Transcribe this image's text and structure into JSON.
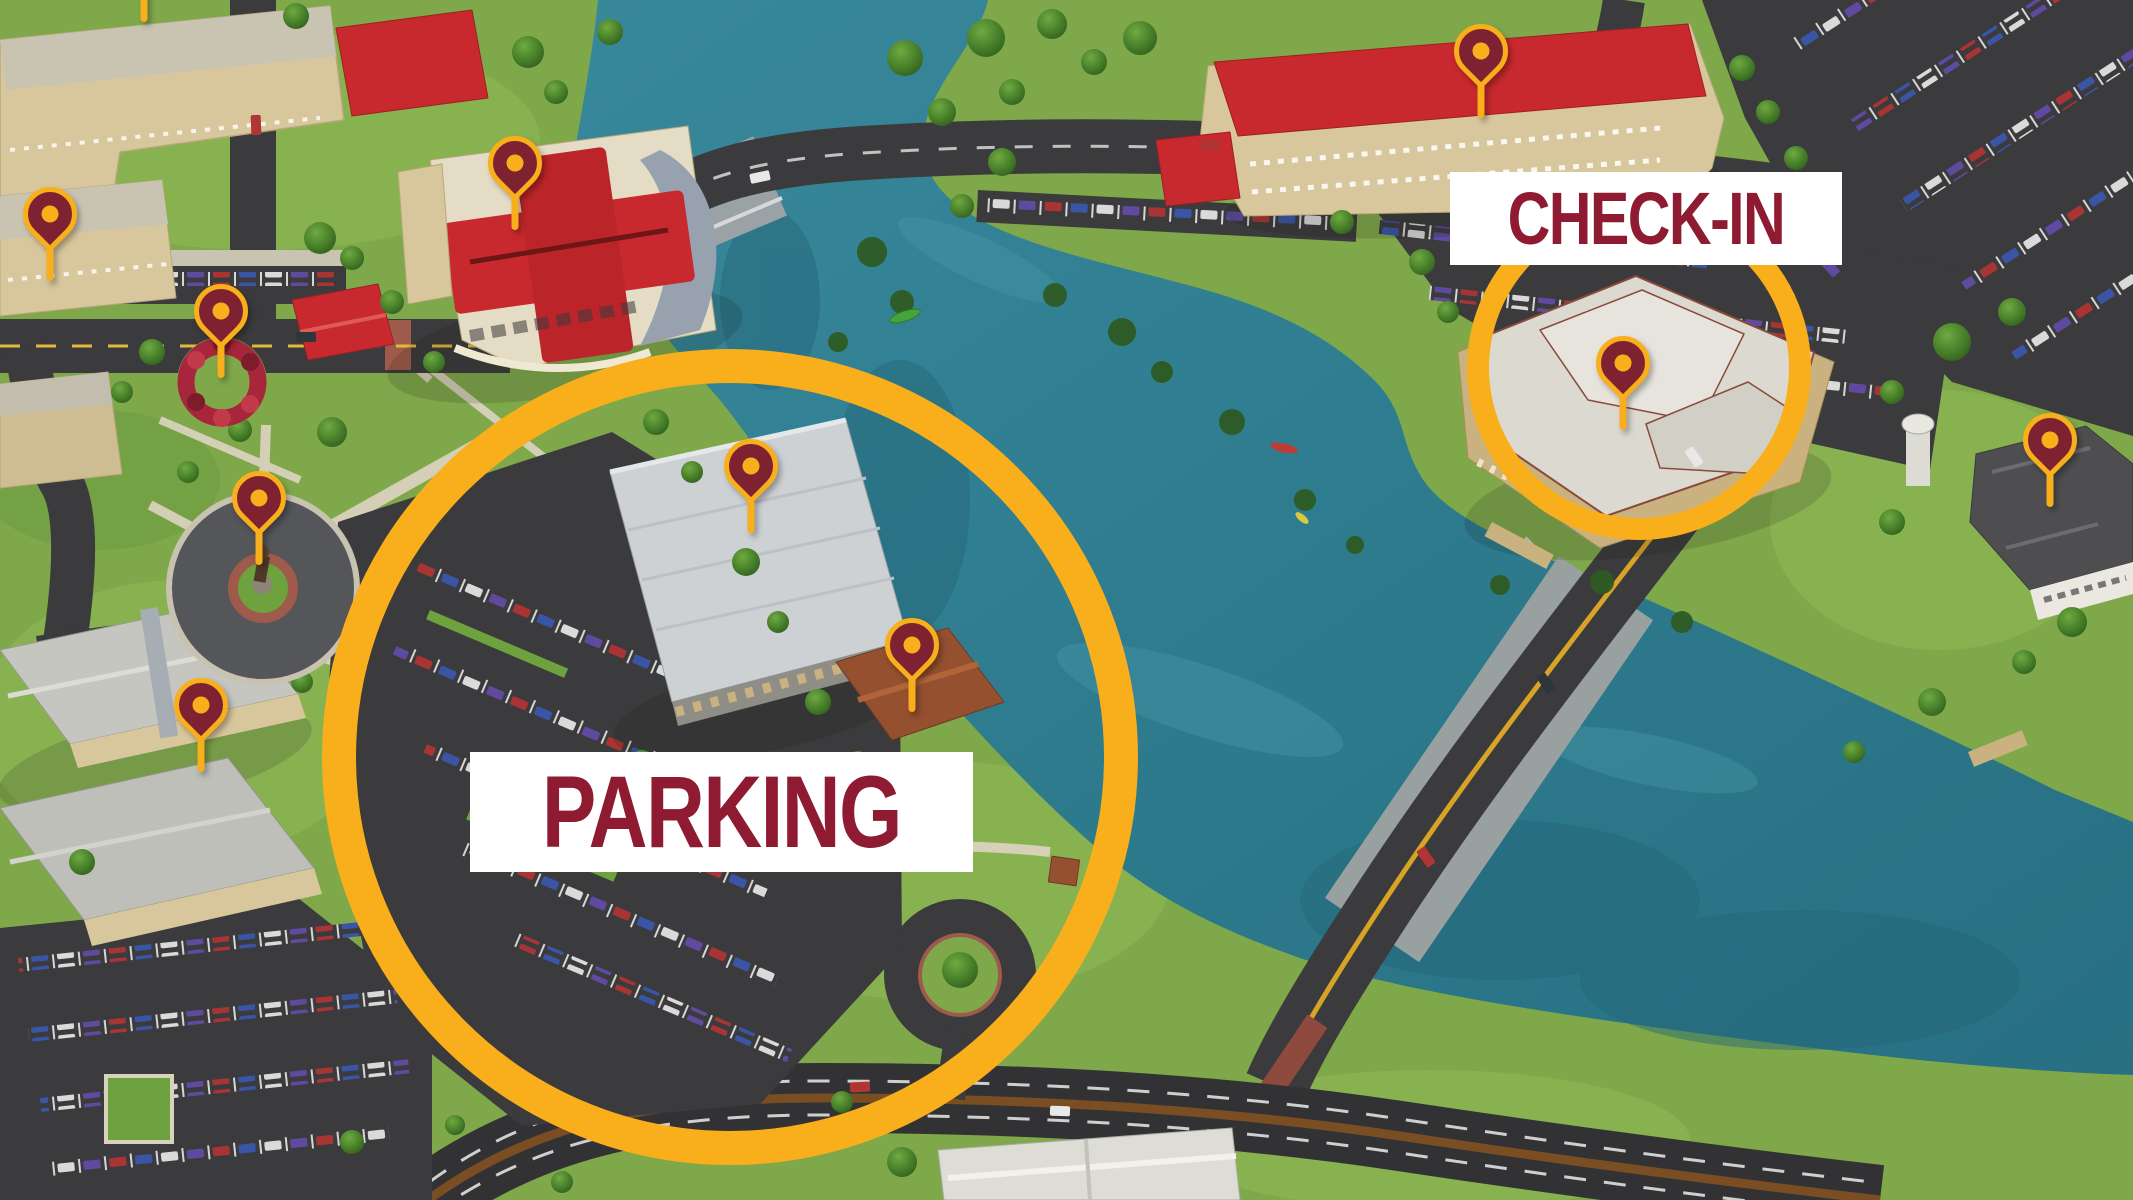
{
  "annotations": {
    "labels": [
      {
        "id": "parking",
        "text": "PARKING",
        "style": "left:470px;top:752px;width:503px;height:120px;font-size:102px"
      },
      {
        "id": "checkin",
        "text": "CHECK-IN",
        "style": "left:1450px;top:172px;width:392px;height:93px;font-size:74px"
      }
    ],
    "highlight_circles": [
      {
        "id": "parking-circle",
        "style": "left:322px;top:349px;width:816px;height:816px;border-width:34px"
      },
      {
        "id": "checkin-circle",
        "style": "left:1467px;top:196px;width:344px;height:344px;border-width:22px"
      }
    ],
    "pins": [
      {
        "id": "north-edge",
        "x": 144,
        "y": 22
      },
      {
        "id": "west-residence-hall",
        "x": 50,
        "y": 281
      },
      {
        "id": "flower-garden",
        "x": 221,
        "y": 378
      },
      {
        "id": "student-union",
        "x": 515,
        "y": 230
      },
      {
        "id": "statue-plaza",
        "x": 259,
        "y": 565
      },
      {
        "id": "west-hall",
        "x": 201,
        "y": 772
      },
      {
        "id": "parking-garage",
        "x": 751,
        "y": 533
      },
      {
        "id": "parking-pavilion",
        "x": 912,
        "y": 712
      },
      {
        "id": "northeast-hotel",
        "x": 1481,
        "y": 118
      },
      {
        "id": "check-in-building",
        "x": 1623,
        "y": 430
      },
      {
        "id": "east-house",
        "x": 2050,
        "y": 507
      }
    ]
  },
  "colors": {
    "highlight_gold": "#F8AF1B",
    "pin_fill_maroon": "#7E2231",
    "label_text_maroon": "#8E1B32",
    "label_background": "#FFFFFF",
    "water_teal": "#2E7C8F",
    "grass_green": "#7FA84A",
    "road_asphalt": "#3B3B3D",
    "building_red_roof": "#C8292E",
    "building_tan": "#D8C79C"
  }
}
